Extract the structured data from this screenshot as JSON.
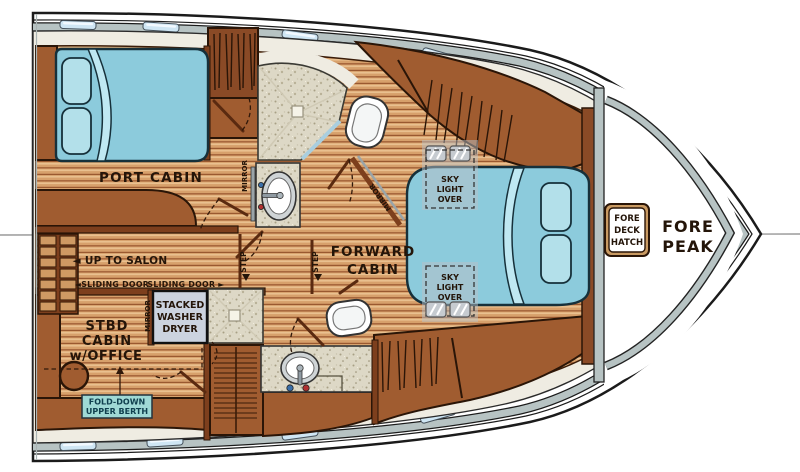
{
  "title": "Yacht bow-section interior floor plan",
  "colors": {
    "hull_outline": "#1b1b1b",
    "deck_white": "#ffffff",
    "window_band": "#b7c3c3",
    "window_glass": "#cfe6f4",
    "lining": "#efece2",
    "floor_base": "#d7a06b",
    "floor_plank_line": "#94512a",
    "cabinet_brown": "#a05c30",
    "cabinet_dark": "#7d3f1d",
    "outline_dark": "#2a1507",
    "bed_blue": "#8ccbdc",
    "bed_light": "#b3e0ea",
    "speckle_bg": "#ddd8c6",
    "washer_bg": "#ccd3df",
    "label_teal_bg": "#9fd9d5",
    "text_dark": "#241509"
  },
  "rooms": {
    "port_cabin": {
      "label": "PORT CABIN"
    },
    "forward_cabin": {
      "line1": "FORWARD",
      "line2": "CABIN"
    },
    "stbd_cabin": {
      "line1": "STBD",
      "line2": "CABIN",
      "line3": "w/OFFICE"
    },
    "fore_peak": {
      "line1": "FORE",
      "line2": "PEAK"
    }
  },
  "labels": {
    "up_to_salon": "◄ UP TO SALON",
    "sliding_door_left": "◄SLIDING DOOR",
    "sliding_door_right": "SLIDING DOOR ►",
    "step": "STEP",
    "mirror": "MIRROR",
    "washer_dryer": {
      "line1": "STACKED",
      "line2": "WASHER",
      "line3": "DRYER"
    },
    "fold_down_berth": {
      "line1": "FOLD-DOWN",
      "line2": "UPPER BERTH"
    },
    "fore_deck_hatch": {
      "line1": "FORE",
      "line2": "DECK",
      "line3": "HATCH"
    },
    "skylight": {
      "line1": "SKY",
      "line2": "LIGHT",
      "line3": "OVER"
    }
  }
}
